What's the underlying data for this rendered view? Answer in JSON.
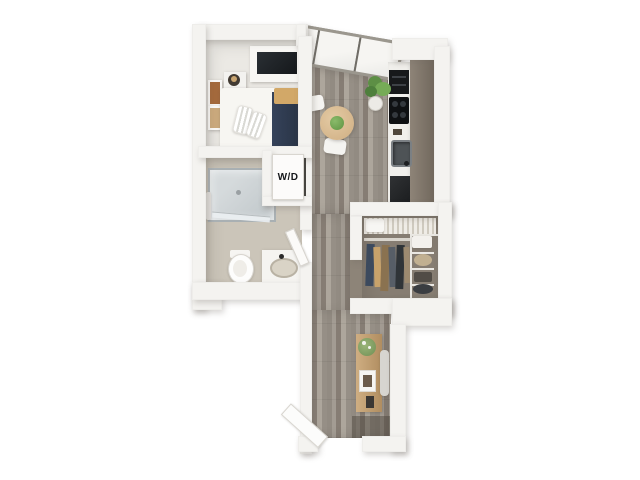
{
  "plan": {
    "type": "3d-floor-plan-studio-apartment",
    "labels": {
      "washer_dryer": "W/D"
    },
    "rooms": [
      {
        "name": "bedroom",
        "furniture": [
          "bed",
          "navy-runner",
          "pillows",
          "wardrobe-tv",
          "nightstand",
          "lamp",
          "wall-art"
        ]
      },
      {
        "name": "bathroom",
        "furniture": [
          "shower",
          "toilet",
          "vanity-sink",
          "bathroom-door",
          "towel-rail"
        ]
      },
      {
        "name": "laundry-nook",
        "furniture": [
          "washer-dryer-unit"
        ]
      },
      {
        "name": "kitchen",
        "furniture": [
          "counter",
          "oven-stack",
          "cooktop",
          "sink",
          "refrigerator"
        ]
      },
      {
        "name": "dining",
        "furniture": [
          "round-table",
          "table-plant",
          "chair",
          "chair"
        ]
      },
      {
        "name": "closet",
        "furniture": [
          "shelf",
          "storage-box",
          "hanging-clothes",
          "wire-shelving-unit"
        ]
      },
      {
        "name": "entry-hall",
        "furniture": [
          "console-table",
          "console-plant",
          "picture-frame",
          "entry-door",
          "window-plant"
        ]
      }
    ],
    "colors": {
      "background": "#ffffff",
      "wall": "#f4f3f0",
      "wood_floor": "#9a938a",
      "bathroom_floor": "#cbc5b9",
      "closet_floor": "#867d72",
      "kitchen_cabinet_band": "#8e8478",
      "accent_navy": "#2e3a4d",
      "accent_tan": "#d2a868",
      "plant_green": "#6da14e",
      "table_wood": "#d9bd96",
      "appliance_black": "#17191b"
    }
  }
}
